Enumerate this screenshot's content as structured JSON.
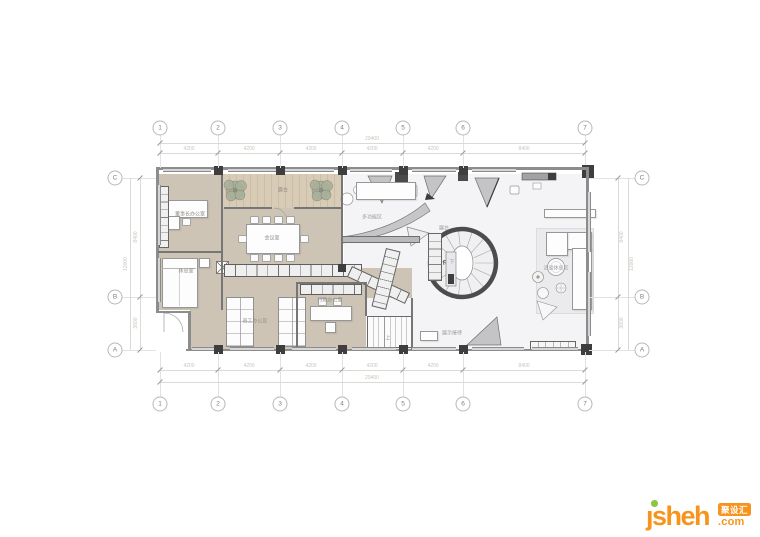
{
  "drawing": {
    "grid": {
      "cols": [
        "1",
        "2",
        "3",
        "4",
        "5",
        "6",
        "7"
      ],
      "rows": [
        "C",
        "B",
        "A"
      ]
    },
    "dims": {
      "h": [
        "4200",
        "4200",
        "4200",
        "4200",
        "4200",
        "8400"
      ],
      "h_total": "29400",
      "v": [
        "8400",
        "3600"
      ],
      "v_total": "12000"
    },
    "rooms": {
      "office": "董事长办公室",
      "rest": "休息室",
      "terrace": "露台",
      "meeting": "会议室",
      "staff": "员工办公区",
      "admin": "行政办公室",
      "multiuse": "多功能区",
      "exhibit": "展台",
      "lounge": "洽谈休息区",
      "reception": "展示接待",
      "stair_up": "上",
      "stair_down": "下"
    },
    "colors": {
      "floor_tan": "#cdc4b6",
      "floor_wood": "#d9ccb6",
      "floor_white": "#f4f4f6",
      "wall": "#8d8d8d",
      "column": "#3e3e3e",
      "tree": "#a9af9a",
      "annotation": "#c8c4be"
    }
  },
  "watermark": {
    "brand": "ȷsheh",
    "badge": "聚设汇",
    "tld": ".com"
  }
}
